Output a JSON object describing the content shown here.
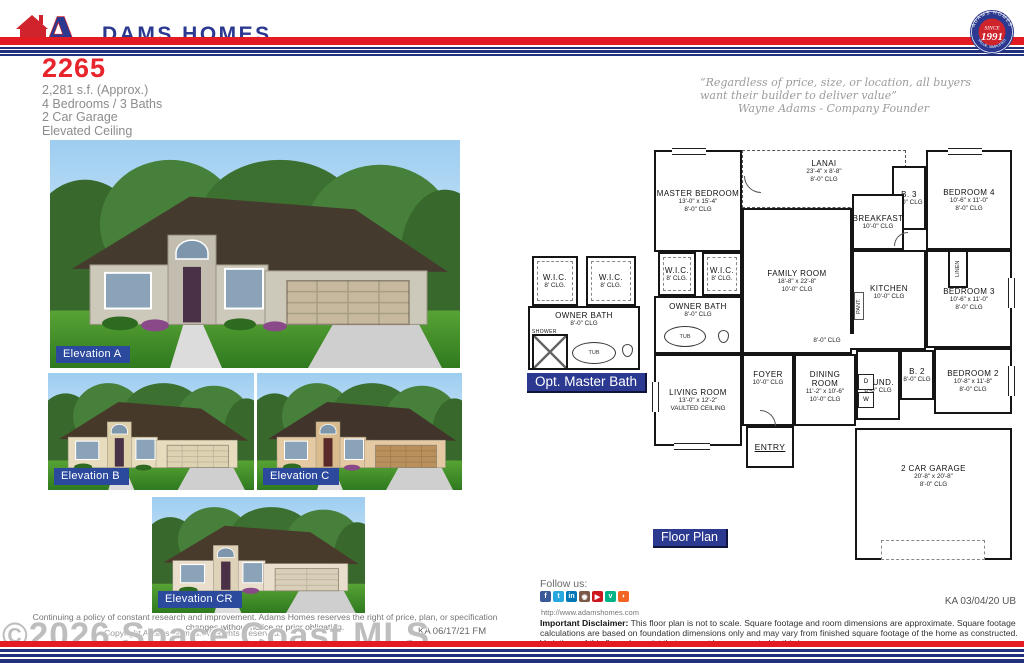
{
  "colors": {
    "brand_red": "#e31b23",
    "brand_navy": "#2b3990",
    "label_blue": "#2b3990",
    "elevation_label_blue": "#2b4a9e"
  },
  "header": {
    "brand_a": "A",
    "brand_rest": "DAMS HOMES",
    "seal": {
      "arc_top": "ADAMS HOMES",
      "since": "SINCE",
      "year": "1991",
      "arc_bottom": "VALUE, SIMPLIFIED"
    }
  },
  "plan": {
    "model": "2265",
    "specs": [
      "2,281 s.f. (Approx.)",
      "4 Bedrooms / 3 Baths",
      "2 Car Garage",
      "Elevated Ceiling"
    ]
  },
  "quote": {
    "line1": "“Regardless of price, size, or location, all buyers",
    "line2": "want their builder to deliver value”",
    "attribution": "Wayne Adams - Company Founder"
  },
  "photos": {
    "a": "Elevation A",
    "b": "Elevation B",
    "c": "Elevation C",
    "cr": "Elevation CR"
  },
  "floorplan": {
    "label": "Floor Plan",
    "opt_label": "Opt. Master Bath",
    "rooms": {
      "master": {
        "name": "MASTER BEDROOM",
        "dims": "13'-0\" x 15'-4\"",
        "clg": "8'-0\" CLG"
      },
      "lanai": {
        "name": "LANAI",
        "dims": "23'-4\" x 8'-8\"",
        "clg": "8'-0\" CLG"
      },
      "breakfast": {
        "name": "BREAKFAST",
        "clg": "10'-0\" CLG"
      },
      "b3": {
        "name": "B. 3",
        "clg": "8'-0\" CLG"
      },
      "bedroom4": {
        "name": "BEDROOM 4",
        "dims": "10'-6\" x 11'-0\"",
        "clg": "8'-0\" CLG"
      },
      "family": {
        "name": "FAMILY ROOM",
        "dims": "18'-8\" x 22'-8\"",
        "clg": "10'-0\" CLG"
      },
      "kitchen": {
        "name": "KITCHEN",
        "clg": "10'-0\" CLG"
      },
      "bedroom3": {
        "name": "BEDROOM 3",
        "dims": "10'-6\" x 11'-0\"",
        "clg": "8'-0\" CLG"
      },
      "hall": {
        "clg": "8'-0\" CLG"
      },
      "b2": {
        "name": "B. 2",
        "clg": "8'-0\" CLG"
      },
      "bedroom2": {
        "name": "BEDROOM 2",
        "dims": "10'-8\" x 11'-8\"",
        "clg": "8'-0\" CLG"
      },
      "laund": {
        "name": "LAUND.",
        "clg": "8'-0\" CLG"
      },
      "living": {
        "name": "LIVING ROOM",
        "dims": "13'-0\" x 12'-2\"",
        "clg": "VAULTED CEILING"
      },
      "foyer": {
        "name": "FOYER",
        "clg": "10'-0\" CLG"
      },
      "dining": {
        "name": "DINING ROOM",
        "dims": "11'-2\" x 10'-6\"",
        "clg": "10'-0\" CLG"
      },
      "entry": {
        "name": "ENTRY"
      },
      "garage": {
        "name": "2 CAR GARAGE",
        "dims": "20'-8\" x 20'-8\"",
        "clg": "8'-0\" CLG"
      },
      "wic": {
        "name": "W.I.C.",
        "clg": "8' CLG."
      },
      "owner_bath": {
        "name": "OWNER BATH",
        "clg": "8'-0\" CLG"
      },
      "linen": {
        "name": "LINEN"
      },
      "pant": {
        "name": "PANT."
      },
      "tub": {
        "name": "TUB"
      },
      "shower": {
        "name": "SHOWER"
      },
      "washer": {
        "name": "W"
      },
      "dryer": {
        "name": "D"
      }
    }
  },
  "footer": {
    "follow": "Follow us:",
    "social": [
      {
        "name": "facebook",
        "glyph": "f"
      },
      {
        "name": "twitter",
        "glyph": "t"
      },
      {
        "name": "linkedin",
        "glyph": "in"
      },
      {
        "name": "instagram",
        "glyph": "◉"
      },
      {
        "name": "youtube",
        "glyph": "▶"
      },
      {
        "name": "vine",
        "glyph": "v"
      },
      {
        "name": "rss",
        "glyph": "◗"
      }
    ],
    "url": "http://www.adamshomes.com",
    "disclaimer_bold": "Important Disclaimer:",
    "disclaimer_rest": " This floor plan is not to scale. Square footage and room dimensions are approximate. Square footage calculations are based on foundation dimensions only and may vary from finished square footage of the home as constructed. Variations of this floor plan exist that may not be represented in this image.",
    "stamp_right": "KA 03/04/20 UB",
    "left_line1": "Continuing a policy of constant research and improvement. Adams Homes reserves the right of price, plan, or specification changes without notice or prior obligation.",
    "left_line2": "Copyright Adams Homes. All Rights Reserved.",
    "stamp_left": "KA 06/17/21 FM",
    "watermark": "©2026 Space Coast MLS"
  }
}
